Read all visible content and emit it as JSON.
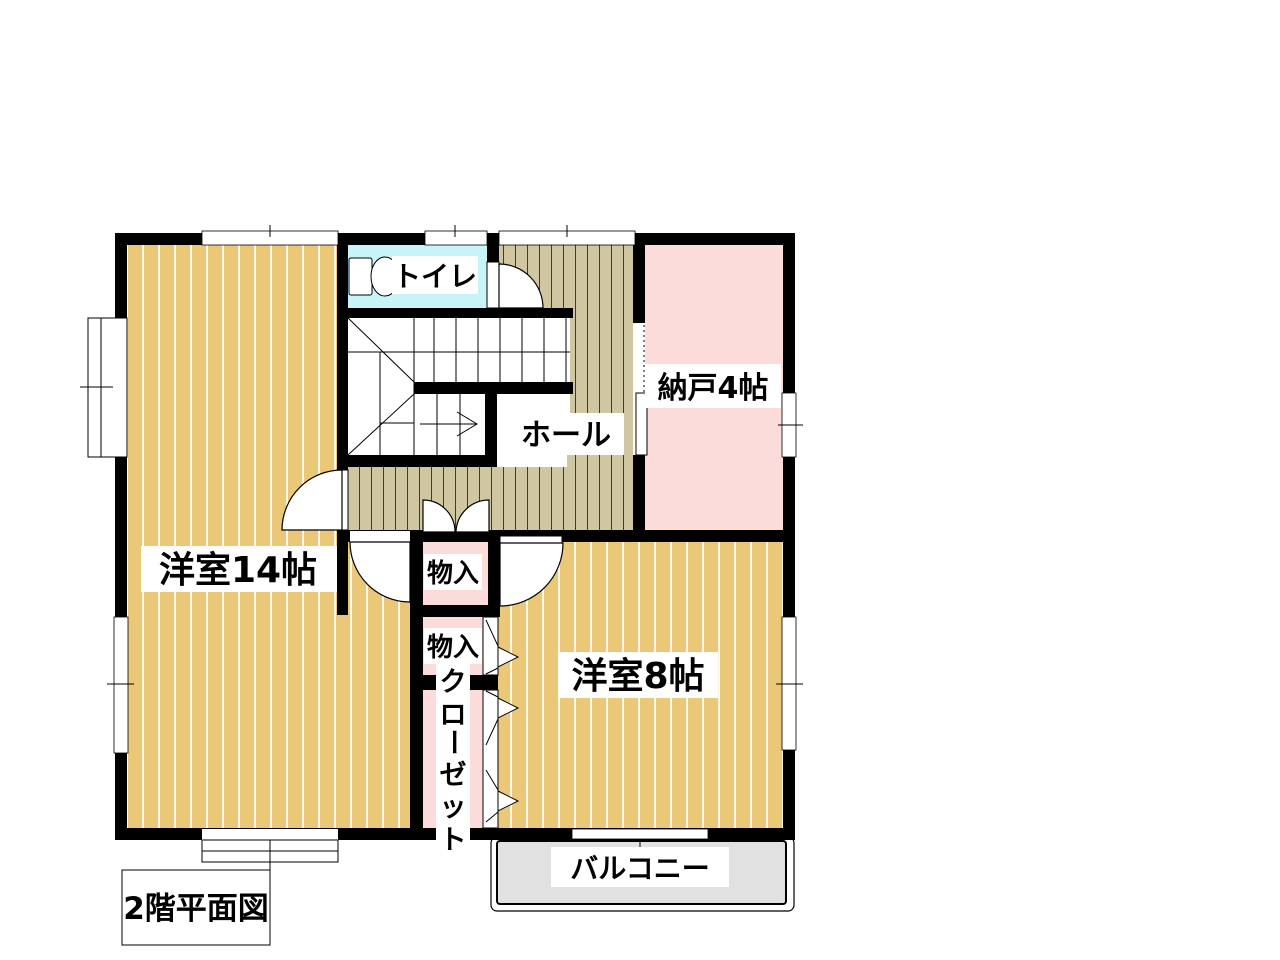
{
  "title": "2階平面図",
  "colors": {
    "wall": "#000000",
    "room_floor": "#ebc878",
    "room_stripe": "#ffffff",
    "hall_floor": "#cec7a2",
    "hall_stripe": "#3c3c30",
    "storage_pink": "#fcdbdb",
    "toilet_cyan": "#c9f4f7",
    "balcony_gray": "#e1e1e1",
    "background": "#ffffff"
  },
  "labels": {
    "room14": "洋室14帖",
    "room8": "洋室8帖",
    "toilet": "トイレ",
    "hall": "ホール",
    "storage": "納戸4帖",
    "closet_top": "物入",
    "closet_mid": "物入",
    "closet_vertical": "クローゼット",
    "closet_vertical_chars": [
      "ク",
      "ロ",
      "ー",
      "ゼ",
      "ッ",
      "ト"
    ],
    "balcony": "バルコニー",
    "caption": "2階平面図"
  }
}
